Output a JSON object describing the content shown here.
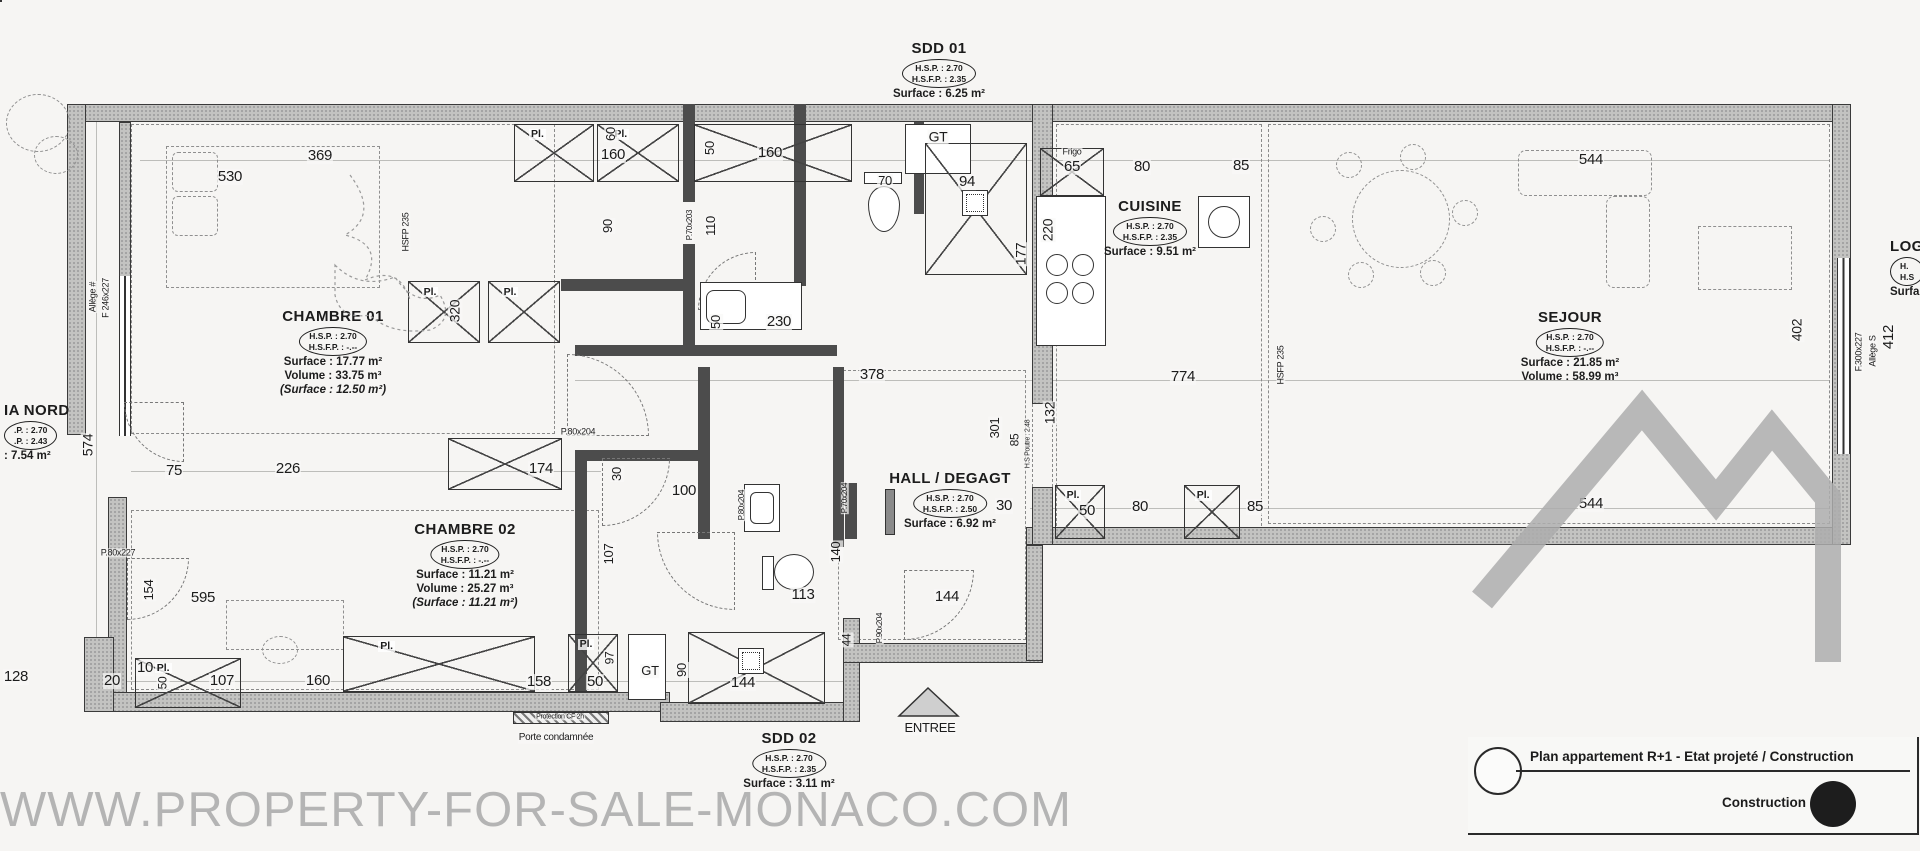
{
  "watermark": {
    "text": "WWW.PROPERTY-FOR-SALE-MONACO.COM"
  },
  "legend": {
    "title": "Plan appartement R+1 - Etat projeté / Construction",
    "construction_label": "Construction"
  },
  "rooms": [
    {
      "id": "sdd01",
      "name": "SDD 01",
      "oval1": "H.S.P. : 2.70",
      "oval2": "H.S.F.P. : 2.35",
      "line1": "Surface : 6.25 m²",
      "x": 939,
      "y": 40
    },
    {
      "id": "chambre01",
      "name": "CHAMBRE 01",
      "oval1": "H.S.P. : 2.70",
      "oval2": "H.S.F.P. : -.--",
      "line1": "Surface : 17.77 m²",
      "line2": "Volume : 33.75 m³",
      "line3": "(Surface : 12.50 m²)",
      "x": 333,
      "y": 308
    },
    {
      "id": "cuisine",
      "name": "CUISINE",
      "oval1": "H.S.P. : 2.70",
      "oval2": "H.S.F.P. : 2.35",
      "line1": "Surface : 9.51 m²",
      "x": 1150,
      "y": 198
    },
    {
      "id": "sejour",
      "name": "SEJOUR",
      "oval1": "H.S.P. : 2.70",
      "oval2": "H.S.F.P. : -.--",
      "line1": "Surface : 21.85 m²",
      "line2": "Volume : 58.99 m³",
      "x": 1570,
      "y": 309
    },
    {
      "id": "hall",
      "name": "HALL / DEGAGT",
      "oval1": "H.S.P. : 2.70",
      "oval2": "H.S.F.P. : 2.50",
      "line1": "Surface : 6.92 m²",
      "x": 950,
      "y": 470
    },
    {
      "id": "chambre02",
      "name": "CHAMBRE 02",
      "oval1": "H.S.P. : 2.70",
      "oval2": "H.S.F.P. : -.--",
      "line1": "Surface : 11.21 m²",
      "line2": "Volume : 25.27 m³",
      "line3": "(Surface : 11.21 m²)",
      "x": 465,
      "y": 521
    },
    {
      "id": "sdd02",
      "name": "SDD 02",
      "oval1": "H.S.P. : 2.70",
      "oval2": "H.S.F.P. : 2.35",
      "line1": "Surface : 3.11 m²",
      "x": 789,
      "y": 730
    },
    {
      "id": "loggia-nord",
      "name": "IA NORD",
      "oval1": ".P. : 2.70",
      "oval2": ".P. : 2.43",
      "line1": ": 7.54 m²",
      "x": 4,
      "y": 402,
      "noshift": true
    },
    {
      "id": "loggia-est",
      "name": "LOG",
      "oval1": "H.",
      "oval2": "H.S",
      "line1": "Surfa",
      "x": 1890,
      "y": 238,
      "noshift": true
    }
  ],
  "closets": [
    {
      "x": 514,
      "y": 124,
      "w": 80,
      "h": 58,
      "l": "Pl."
    },
    {
      "x": 597,
      "y": 124,
      "w": 82,
      "h": 58,
      "l": "Pl."
    },
    {
      "x": 694,
      "y": 124,
      "w": 158,
      "h": 58,
      "l": ""
    },
    {
      "x": 408,
      "y": 281,
      "w": 72,
      "h": 62,
      "l": "Pl."
    },
    {
      "x": 488,
      "y": 281,
      "w": 72,
      "h": 62,
      "l": "Pl."
    },
    {
      "x": 448,
      "y": 438,
      "w": 114,
      "h": 52,
      "l": ""
    },
    {
      "x": 1055,
      "y": 485,
      "w": 50,
      "h": 54,
      "l": "Pl."
    },
    {
      "x": 1184,
      "y": 485,
      "w": 56,
      "h": 54,
      "l": "Pl."
    },
    {
      "x": 135,
      "y": 658,
      "w": 106,
      "h": 50,
      "l": "Pl."
    },
    {
      "x": 343,
      "y": 636,
      "w": 192,
      "h": 56,
      "l": "Pl."
    },
    {
      "x": 568,
      "y": 634,
      "w": 50,
      "h": 58,
      "l": "Pl."
    }
  ],
  "labels": [
    {
      "t": "369",
      "x": 320,
      "y": 156
    },
    {
      "t": "530",
      "x": 230,
      "y": 177
    },
    {
      "t": "160",
      "x": 613,
      "y": 155
    },
    {
      "t": "60",
      "x": 611,
      "y": 134,
      "r": 90,
      "s": 13
    },
    {
      "t": "50",
      "x": 710,
      "y": 148,
      "r": 90,
      "s": 13
    },
    {
      "t": "160",
      "x": 770,
      "y": 153
    },
    {
      "t": "GT",
      "x": 938,
      "y": 137,
      "s": 14
    },
    {
      "t": "70",
      "x": 885,
      "y": 181,
      "s": 13
    },
    {
      "t": "94",
      "x": 967,
      "y": 182
    },
    {
      "t": "90",
      "x": 608,
      "y": 226,
      "r": 90,
      "s": 13
    },
    {
      "t": "110",
      "x": 711,
      "y": 226,
      "r": 90,
      "s": 13
    },
    {
      "t": "P.70x203",
      "x": 690,
      "y": 225,
      "r": 90,
      "s": 8
    },
    {
      "t": "230",
      "x": 779,
      "y": 322
    },
    {
      "t": "50",
      "x": 716,
      "y": 322,
      "r": 90,
      "s": 13
    },
    {
      "t": "Frigo",
      "x": 1072,
      "y": 152,
      "s": 9
    },
    {
      "t": "65",
      "x": 1072,
      "y": 167
    },
    {
      "t": "80",
      "x": 1142,
      "y": 167
    },
    {
      "t": "85",
      "x": 1241,
      "y": 166
    },
    {
      "t": "220",
      "x": 1048,
      "y": 230,
      "r": 90,
      "s": 14
    },
    {
      "t": "177",
      "x": 1021,
      "y": 254,
      "r": 90,
      "s": 14
    },
    {
      "t": "544",
      "x": 1591,
      "y": 160
    },
    {
      "t": "HSFP 235",
      "x": 406,
      "y": 232,
      "r": 90,
      "s": 9
    },
    {
      "t": "320",
      "x": 455,
      "y": 311,
      "r": 90,
      "s": 14
    },
    {
      "t": "574",
      "x": 88,
      "y": 445,
      "r": 90,
      "s": 14
    },
    {
      "t": "F 246x227",
      "x": 106,
      "y": 298,
      "r": 90,
      "s": 9
    },
    {
      "t": "Allège #",
      "x": 93,
      "y": 297,
      "r": 90,
      "s": 9
    },
    {
      "t": "75",
      "x": 174,
      "y": 471
    },
    {
      "t": "226",
      "x": 288,
      "y": 469
    },
    {
      "t": "174",
      "x": 541,
      "y": 469
    },
    {
      "t": "30",
      "x": 617,
      "y": 474,
      "r": 90,
      "s": 13
    },
    {
      "t": "P.80x204",
      "x": 578,
      "y": 432,
      "s": 9
    },
    {
      "t": "100",
      "x": 684,
      "y": 491
    },
    {
      "t": "378",
      "x": 872,
      "y": 375
    },
    {
      "t": "774",
      "x": 1183,
      "y": 377
    },
    {
      "t": "301",
      "x": 995,
      "y": 428,
      "r": 90,
      "s": 13
    },
    {
      "t": "85",
      "x": 1015,
      "y": 440,
      "r": 90,
      "s": 12
    },
    {
      "t": "132",
      "x": 1050,
      "y": 413,
      "r": 90,
      "s": 14
    },
    {
      "t": "H.S Poutre : 2.48",
      "x": 1028,
      "y": 444,
      "r": 90,
      "s": 7
    },
    {
      "t": "HSFP 235",
      "x": 1281,
      "y": 365,
      "r": 90,
      "s": 9
    },
    {
      "t": "30",
      "x": 1004,
      "y": 506
    },
    {
      "t": "50",
      "x": 1087,
      "y": 511
    },
    {
      "t": "80",
      "x": 1140,
      "y": 507
    },
    {
      "t": "85",
      "x": 1255,
      "y": 507
    },
    {
      "t": "544",
      "x": 1591,
      "y": 504
    },
    {
      "t": "402",
      "x": 1797,
      "y": 330,
      "r": 90,
      "s": 14
    },
    {
      "t": "412",
      "x": 1889,
      "y": 337,
      "r": 90,
      "s": 15
    },
    {
      "t": "F.300x227",
      "x": 1859,
      "y": 352,
      "r": 90,
      "s": 9
    },
    {
      "t": "Allège S",
      "x": 1873,
      "y": 351,
      "r": 90,
      "s": 9
    },
    {
      "t": "P.80x204",
      "x": 742,
      "y": 505,
      "r": 90,
      "s": 8
    },
    {
      "t": "P.70x204",
      "x": 845,
      "y": 498,
      "r": 90,
      "s": 8
    },
    {
      "t": "140",
      "x": 836,
      "y": 552,
      "r": 90,
      "s": 13
    },
    {
      "t": "113",
      "x": 803,
      "y": 595
    },
    {
      "t": "144",
      "x": 947,
      "y": 597
    },
    {
      "t": "107",
      "x": 609,
      "y": 554,
      "r": 90,
      "s": 13
    },
    {
      "t": "154",
      "x": 149,
      "y": 590,
      "r": 90,
      "s": 13
    },
    {
      "t": "595",
      "x": 203,
      "y": 598
    },
    {
      "t": "P.80x227",
      "x": 118,
      "y": 553,
      "s": 9
    },
    {
      "t": "128",
      "x": 16,
      "y": 677
    },
    {
      "t": "20",
      "x": 112,
      "y": 681
    },
    {
      "t": "10",
      "x": 145,
      "y": 668
    },
    {
      "t": "50",
      "x": 163,
      "y": 683,
      "r": 90,
      "s": 12
    },
    {
      "t": "107",
      "x": 222,
      "y": 681
    },
    {
      "t": "160",
      "x": 318,
      "y": 681
    },
    {
      "t": "158",
      "x": 539,
      "y": 682
    },
    {
      "t": "50",
      "x": 595,
      "y": 682
    },
    {
      "t": "97",
      "x": 610,
      "y": 658,
      "r": 90,
      "s": 12
    },
    {
      "t": "GT",
      "x": 650,
      "y": 671,
      "s": 13
    },
    {
      "t": "90",
      "x": 682,
      "y": 670,
      "r": 90,
      "s": 13
    },
    {
      "t": "144",
      "x": 743,
      "y": 683
    },
    {
      "t": "44",
      "x": 847,
      "y": 640,
      "r": 90,
      "s": 12
    },
    {
      "t": "P.90x204",
      "x": 880,
      "y": 628,
      "r": 90,
      "s": 8
    },
    {
      "t": "Porte condamnée",
      "x": 556,
      "y": 738,
      "s": 10
    },
    {
      "t": "Protection CF 2h",
      "x": 560,
      "y": 717,
      "s": 7
    },
    {
      "t": "ENTREE",
      "x": 930,
      "y": 728,
      "s": 13
    }
  ]
}
